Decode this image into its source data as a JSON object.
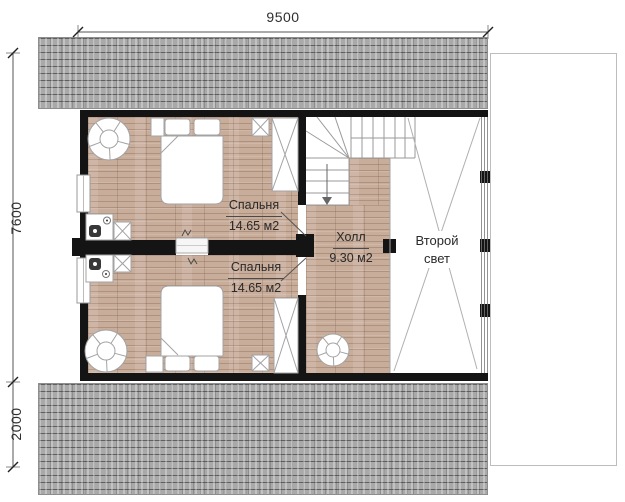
{
  "plan": {
    "dimensions": {
      "top_width": "9500",
      "left_height_main": "7600",
      "left_height_lower": "2000"
    },
    "rooms": {
      "bedroom_top": {
        "name": "Спальня",
        "area": "14.65 м2"
      },
      "bedroom_bottom": {
        "name": "Спальня",
        "area": "14.65 м2"
      },
      "hall": {
        "name": "Холл",
        "area": "9.30 м2"
      },
      "second_light": {
        "line1": "Второй",
        "line2": "свет"
      }
    },
    "colors": {
      "wall": "#141414",
      "wood_floor": "#c8ad9b",
      "roof": "#a9a9a9",
      "dimension": "#444444"
    }
  }
}
